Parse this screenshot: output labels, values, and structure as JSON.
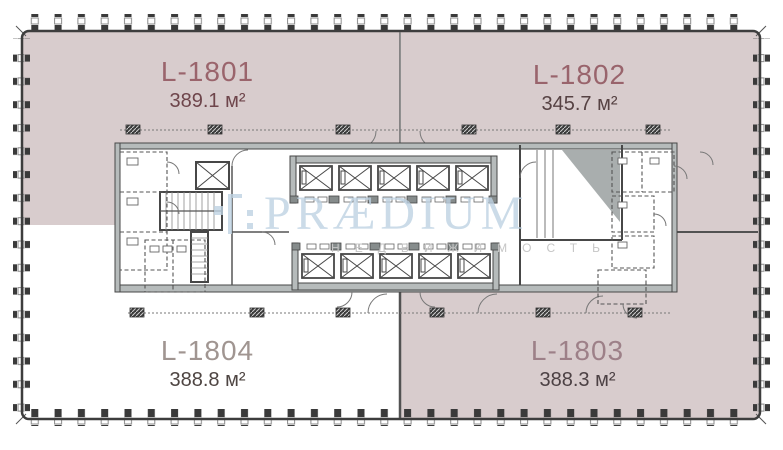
{
  "watermark": {
    "brand": "PRÆDIUM",
    "tagline": "НЕДВИЖИМОСТЬ",
    "brand_color": "#bfd3e3",
    "tagline_color": "#c6c6c6",
    "logo_icon": "praedium-bracket-icon"
  },
  "plan": {
    "unit_fill": "#d8cccd",
    "wall_color": "#474747",
    "outline_color": "#3d3d3d",
    "background": "#ffffff"
  },
  "units": [
    {
      "id": "L-1801",
      "area": "389.1 м²",
      "id_color": "#9a646c",
      "area_color": "#6e454b"
    },
    {
      "id": "L-1802",
      "area": "345.7 м²",
      "id_color": "#99646c",
      "area_color": "#564243"
    },
    {
      "id": "L-1803",
      "area": "388.3 м²",
      "id_color": "#9d8088",
      "area_color": "#4c4144"
    },
    {
      "id": "L-1804",
      "area": "388.8 м²",
      "id_color": "#a09591",
      "area_color": "#4e4542"
    }
  ]
}
